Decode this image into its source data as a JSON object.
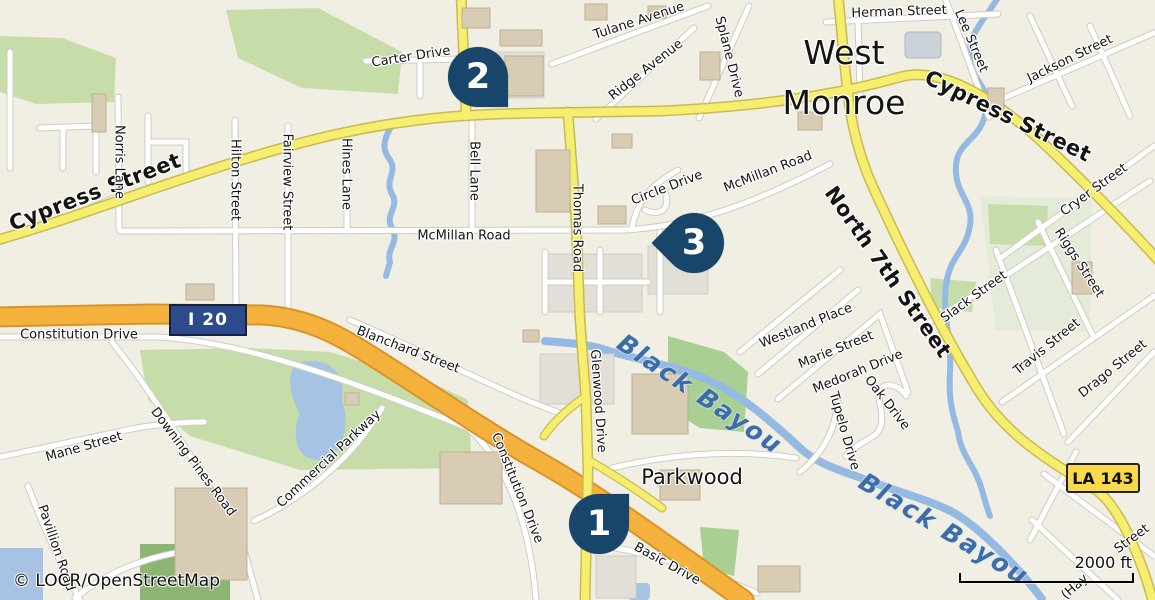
{
  "map": {
    "attribution": "© LOCR/OpenStreetMap",
    "scale_bar": {
      "label": "2000 ft"
    },
    "city_label": {
      "line1": "West",
      "line2": "Monroe"
    },
    "route_shields": [
      {
        "id": "i20",
        "type": "interstate",
        "label": "I 20"
      },
      {
        "id": "la143",
        "type": "state",
        "label": "LA 143"
      }
    ],
    "markers": [
      {
        "number": "1",
        "x": 599,
        "y": 524,
        "tail": "up-right"
      },
      {
        "number": "2",
        "x": 478,
        "y": 77,
        "tail": "down-right"
      },
      {
        "number": "3",
        "x": 694,
        "y": 243,
        "tail": "left"
      }
    ],
    "labels": [
      {
        "id": "cypress-street-west",
        "text": "Cypress Street",
        "x": 95,
        "y": 192,
        "rot": -21,
        "cls": "major"
      },
      {
        "id": "cypress-street-east",
        "text": "Cypress Street",
        "x": 1008,
        "y": 116,
        "rot": 26,
        "cls": "major"
      },
      {
        "id": "north-7th-street",
        "text": "North 7th Street",
        "x": 888,
        "y": 272,
        "rot": 55,
        "cls": "major"
      },
      {
        "id": "black-bayou-west",
        "text": "Black Bayou",
        "x": 700,
        "y": 394,
        "rot": 34,
        "cls": "water"
      },
      {
        "id": "black-bayou-east",
        "text": "Black Bayou",
        "x": 944,
        "y": 529,
        "rot": 31,
        "cls": "water"
      },
      {
        "id": "parkwood",
        "text": "Parkwood",
        "x": 692,
        "y": 477,
        "rot": 0,
        "cls": "place"
      },
      {
        "id": "mcmillan-road-west",
        "text": "McMillan Road",
        "x": 464,
        "y": 236,
        "rot": 0,
        "cls": ""
      },
      {
        "id": "mcmillan-road-east",
        "text": "McMillan Road",
        "x": 768,
        "y": 172,
        "rot": -21,
        "cls": ""
      },
      {
        "id": "thomas-road",
        "text": "Thomas Road",
        "x": 577,
        "y": 228,
        "rot": 90,
        "cls": ""
      },
      {
        "id": "glenwood-drive",
        "text": "Glenwood Drive",
        "x": 598,
        "y": 401,
        "rot": 86,
        "cls": ""
      },
      {
        "id": "constitution-drive-west",
        "text": "Constitution Drive",
        "x": 79,
        "y": 335,
        "rot": 0,
        "cls": ""
      },
      {
        "id": "constitution-drive-south",
        "text": "Constitution Drive",
        "x": 517,
        "y": 488,
        "rot": 68,
        "cls": ""
      },
      {
        "id": "norris-lane",
        "text": "Norris Lane",
        "x": 119,
        "y": 162,
        "rot": 90,
        "cls": ""
      },
      {
        "id": "hilton-street",
        "text": "Hilton Street",
        "x": 235,
        "y": 180,
        "rot": 90,
        "cls": ""
      },
      {
        "id": "fairview-street",
        "text": "Fairview Street",
        "x": 287,
        "y": 182,
        "rot": 90,
        "cls": ""
      },
      {
        "id": "hines-lane",
        "text": "Hines Lane",
        "x": 346,
        "y": 174,
        "rot": 90,
        "cls": ""
      },
      {
        "id": "bell-lane",
        "text": "Bell Lane",
        "x": 474,
        "y": 171,
        "rot": 90,
        "cls": ""
      },
      {
        "id": "carter-drive",
        "text": "Carter Drive",
        "x": 411,
        "y": 57,
        "rot": -9,
        "cls": ""
      },
      {
        "id": "tulane-avenue",
        "text": "Tulane Avenue",
        "x": 639,
        "y": 21,
        "rot": -18,
        "cls": ""
      },
      {
        "id": "ridge-avenue",
        "text": "Ridge Avenue",
        "x": 646,
        "y": 70,
        "rot": -38,
        "cls": ""
      },
      {
        "id": "splane-drive",
        "text": "Splane Drive",
        "x": 729,
        "y": 57,
        "rot": 76,
        "cls": ""
      },
      {
        "id": "herman-street",
        "text": "Herman Street",
        "x": 899,
        "y": 12,
        "rot": -2,
        "cls": ""
      },
      {
        "id": "lee-street",
        "text": "Lee Street",
        "x": 971,
        "y": 41,
        "rot": 67,
        "cls": ""
      },
      {
        "id": "jackson-street",
        "text": "Jackson Street",
        "x": 1070,
        "y": 59,
        "rot": -26,
        "cls": ""
      },
      {
        "id": "cryer-street",
        "text": "Cryer Street",
        "x": 1094,
        "y": 190,
        "rot": -36,
        "cls": ""
      },
      {
        "id": "riggs-street",
        "text": "Riggs Street",
        "x": 1079,
        "y": 263,
        "rot": 57,
        "cls": ""
      },
      {
        "id": "slack-street",
        "text": "Slack Street",
        "x": 974,
        "y": 297,
        "rot": -36,
        "cls": ""
      },
      {
        "id": "travis-street",
        "text": "Travis Street",
        "x": 1047,
        "y": 347,
        "rot": -39,
        "cls": ""
      },
      {
        "id": "drago-street",
        "text": "Drago Street",
        "x": 1113,
        "y": 369,
        "rot": -39,
        "cls": ""
      },
      {
        "id": "circle-drive",
        "text": "Circle Drive",
        "x": 667,
        "y": 188,
        "rot": -21,
        "cls": ""
      },
      {
        "id": "westland-place",
        "text": "Westland Place",
        "x": 806,
        "y": 326,
        "rot": -22,
        "cls": ""
      },
      {
        "id": "marie-street",
        "text": "Marie Street",
        "x": 836,
        "y": 350,
        "rot": -22,
        "cls": ""
      },
      {
        "id": "medorah-drive",
        "text": "Medorah Drive",
        "x": 858,
        "y": 372,
        "rot": -22,
        "cls": ""
      },
      {
        "id": "oak-drive",
        "text": "Oak Drive",
        "x": 887,
        "y": 403,
        "rot": 52,
        "cls": ""
      },
      {
        "id": "tupelo-drive",
        "text": "Tupelo Drive",
        "x": 844,
        "y": 431,
        "rot": 74,
        "cls": ""
      },
      {
        "id": "blanchard-street",
        "text": "Blanchard Street",
        "x": 408,
        "y": 350,
        "rot": 21,
        "cls": ""
      },
      {
        "id": "mane-street",
        "text": "Mane Street",
        "x": 84,
        "y": 447,
        "rot": -16,
        "cls": ""
      },
      {
        "id": "downing-pines-road",
        "text": "Downing Pines Road",
        "x": 193,
        "y": 462,
        "rot": 53,
        "cls": ""
      },
      {
        "id": "pavillion-road",
        "text": "Pavillion Road",
        "x": 56,
        "y": 548,
        "rot": 71,
        "cls": ""
      },
      {
        "id": "commercial-parkway",
        "text": "Commercial Parkway",
        "x": 329,
        "y": 459,
        "rot": -43,
        "cls": ""
      },
      {
        "id": "basic-drive",
        "text": "Basic Drive",
        "x": 667,
        "y": 564,
        "rot": 29,
        "cls": ""
      },
      {
        "id": "street-partial",
        "text": "Street",
        "x": 1132,
        "y": 539,
        "rot": -36,
        "cls": ""
      },
      {
        "id": "hay-street-partial",
        "text": "(Hay",
        "x": 1075,
        "y": 587,
        "rot": -41,
        "cls": ""
      }
    ],
    "colors": {
      "land": "#f1eee3",
      "road_major": "#f6ee6e",
      "freeway": "#f4b13c",
      "water": "#a6c3e3",
      "water_line": "#94b9e2",
      "water_label": "#3c6da6",
      "park": "#c7dda9",
      "marker": "#17466a",
      "shield_interstate": "#2c4a8c",
      "shield_state": "#fada4a"
    }
  }
}
